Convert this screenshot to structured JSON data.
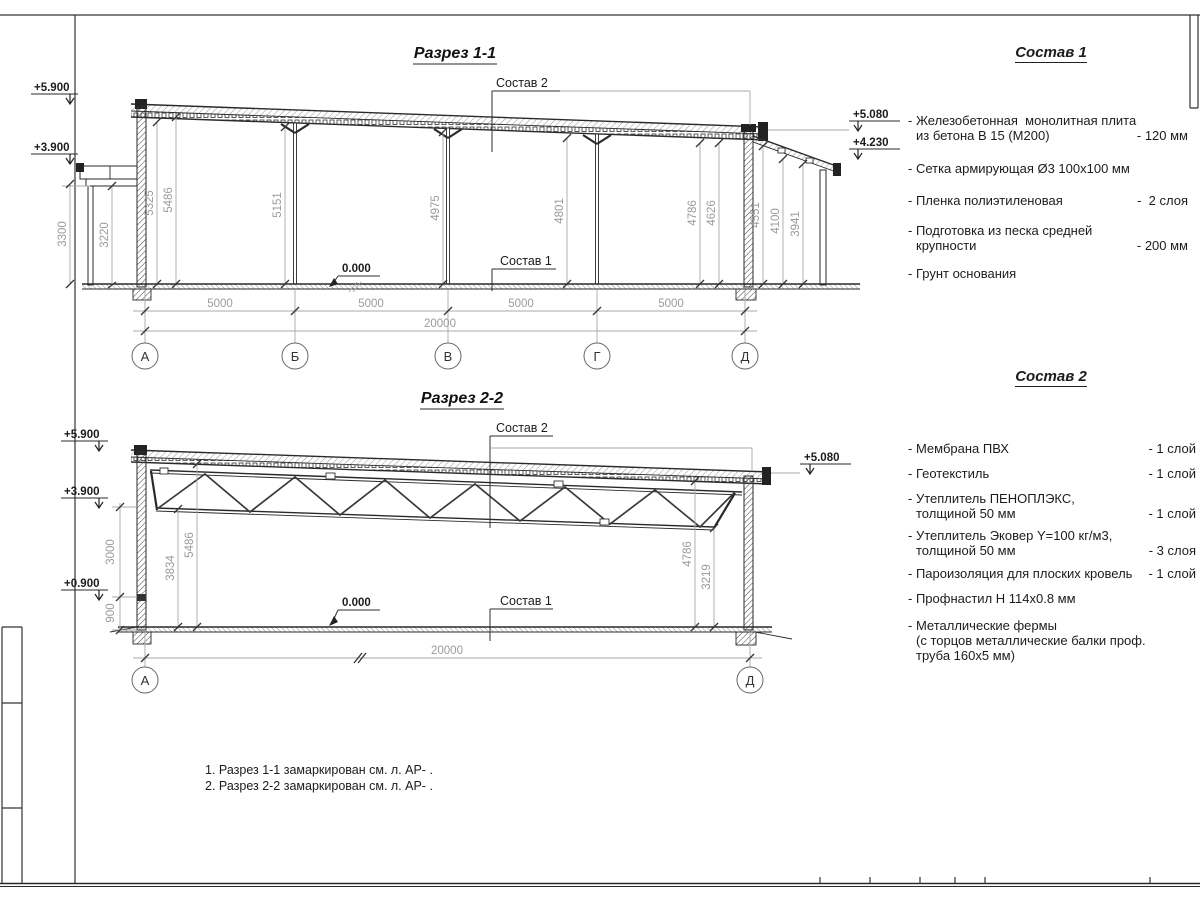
{
  "section1": {
    "title": "Разрез 1-1",
    "composition2_label": "Состав 2",
    "composition1_label": "Состав 1",
    "zero_level": "0.000",
    "elev_left_top": "+5.900",
    "elev_left_mid": "+3.900",
    "elev_right_top": "+5.080",
    "elev_right_mid": "+4.230",
    "vdims": [
      "3300",
      "3220",
      "5325",
      "5486",
      "5151",
      "4975",
      "4801",
      "4786",
      "4626",
      "4551",
      "4100",
      "3941"
    ],
    "hdims": [
      "5000",
      "5000",
      "5000",
      "5000"
    ],
    "total_dim": "20000",
    "axes": [
      "А",
      "Б",
      "В",
      "Г",
      "Д"
    ]
  },
  "section2": {
    "title": "Разрез 2-2",
    "composition2_label": "Состав 2",
    "composition1_label": "Состав 1",
    "zero_level": "0.000",
    "elev_left_top": "+5.900",
    "elev_left_mid": "+3.900",
    "elev_left_low": "+0.900",
    "elev_right_top": "+5.080",
    "vdims": [
      "3000",
      "900",
      "3834",
      "5486",
      "4786",
      "3219"
    ],
    "total_dim": "20000",
    "axes": [
      "А",
      "Д"
    ]
  },
  "composition1": {
    "title": "Состав 1",
    "items": [
      {
        "lines": [
          "- Железобетонная  монолитная плита",
          "из бетона В 15 (М200)"
        ],
        "value": "- 120 мм"
      },
      {
        "lines": [
          "- Сетка армирующая Ø3 100x100 мм"
        ],
        "value": ""
      },
      {
        "lines": [
          "- Пленка полиэтиленовая"
        ],
        "value": "-  2 слоя"
      },
      {
        "lines": [
          "- Подготовка из песка средней",
          "крупности"
        ],
        "value": "- 200 мм"
      },
      {
        "lines": [
          "- Грунт основания"
        ],
        "value": ""
      }
    ]
  },
  "composition2": {
    "title": "Состав 2",
    "items": [
      {
        "lines": [
          "- Мембрана ПВХ"
        ],
        "value": "- 1 слой"
      },
      {
        "lines": [
          "- Геотекстиль"
        ],
        "value": "- 1 слой"
      },
      {
        "lines": [
          "- Утеплитель ПЕНОПЛЭКС,",
          "толщиной 50 мм"
        ],
        "value": "- 1 слой"
      },
      {
        "lines": [
          "- Утеплитель Эковер Y=100 кг/м3,",
          "толщиной 50 мм"
        ],
        "value": "- 3 слоя"
      },
      {
        "lines": [
          "- Пароизоляция для плоских кровель"
        ],
        "value": "- 1 слой"
      },
      {
        "lines": [
          "- Профнастил Н 114x0.8 мм"
        ],
        "value": ""
      },
      {
        "lines": [
          "- Металлические фермы",
          "(с торцов металлические балки проф.",
          "труба 160x5 мм)"
        ],
        "value": ""
      }
    ]
  },
  "notes": [
    "1. Разрез 1-1 замаркирован см. л. АР- .",
    "2. Разрез 2-2 замаркирован см. л. АР- ."
  ]
}
